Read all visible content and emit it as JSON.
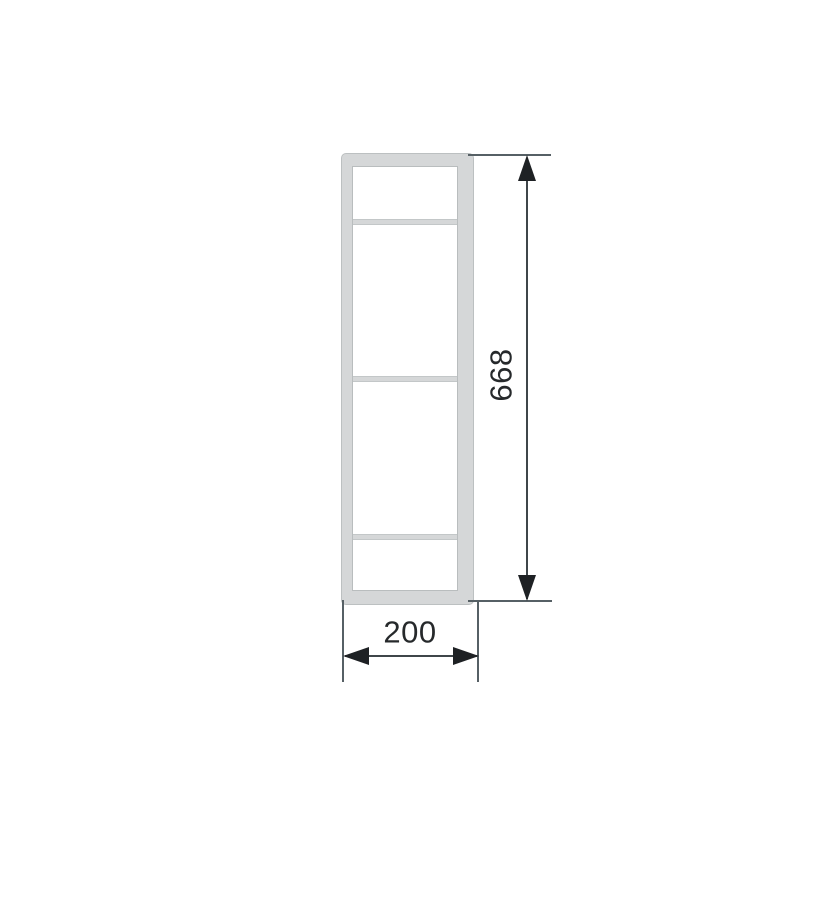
{
  "drawing": {
    "description": "Front elevation technical drawing of a tall rectangular frame unit with three horizontal shelf dividers, annotated with overall height and width dimensions",
    "unit_count": {
      "shelf_dividers": 3,
      "inner_sections": 4
    },
    "dimensions": {
      "height": {
        "label": "668"
      },
      "width": {
        "label": "200"
      }
    },
    "colors": {
      "background": "#ffffff",
      "frame_fill": "#d5d7d8",
      "frame_edge": "#bcc0c1",
      "panel_edge": "#b9bdbe",
      "divider_edge": "#c3c7c8",
      "dimension_line": "#3f464a",
      "extension_line": "#566065",
      "arrowhead": "#1e2124",
      "text": "#26292b"
    }
  }
}
